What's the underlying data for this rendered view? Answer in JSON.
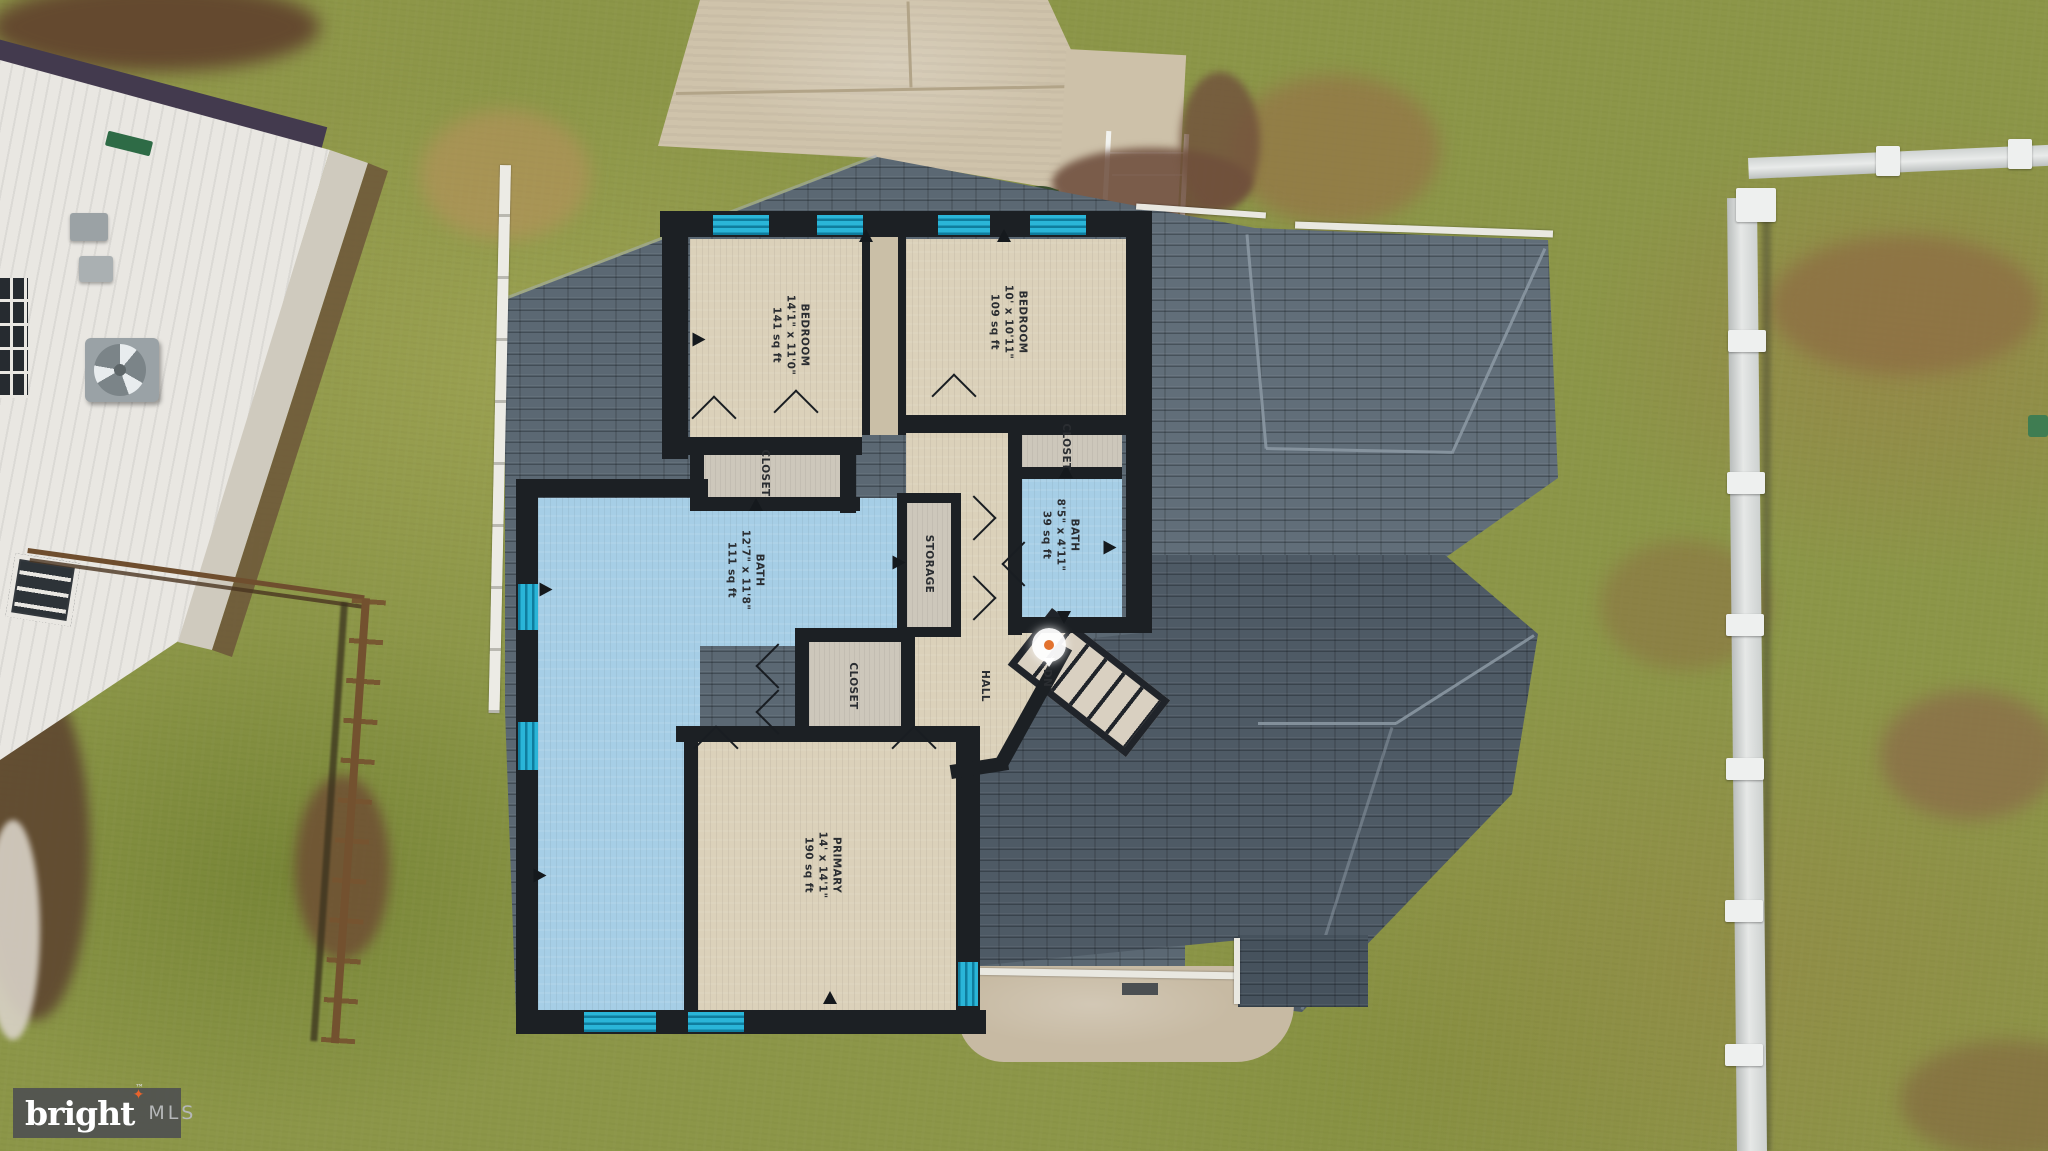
{
  "watermark": {
    "brand": "bright",
    "tm": "™",
    "suffix": "MLS"
  },
  "floorplan": {
    "rooms": [
      {
        "name": "BEDROOM",
        "dims": "14'1\" x 11'0\"",
        "area": "141 sq ft"
      },
      {
        "name": "BEDROOM",
        "dims": "10' x 10'11\"",
        "area": "109 sq ft"
      },
      {
        "name": "BATH",
        "dims": "12'7\" x 11'8\"",
        "area": "111 sq ft"
      },
      {
        "name": "BATH",
        "dims": "8'5\" x 4'11\"",
        "area": "39 sq ft"
      },
      {
        "name": "PRIMARY",
        "dims": "14' x 14'1\"",
        "area": "190 sq ft"
      },
      {
        "name": "CLOSET",
        "dims": "",
        "area": ""
      },
      {
        "name": "CLOSET",
        "dims": "",
        "area": ""
      },
      {
        "name": "CLOSET",
        "dims": "",
        "area": ""
      },
      {
        "name": "STORAGE",
        "dims": "",
        "area": ""
      },
      {
        "name": "HALL",
        "dims": "",
        "area": ""
      },
      {
        "name": "DN",
        "dims": "",
        "area": ""
      }
    ],
    "colors": {
      "wall": "#1c2024",
      "room_beige": "#dbd1ba",
      "bath_blue": "#a6cee6",
      "closet_gray": "#cdc7bb",
      "window_teal": "#1ba2c6"
    },
    "arrows": [
      {
        "x": 866,
        "y": 236,
        "r": 0
      },
      {
        "x": 1004,
        "y": 236,
        "r": 0
      },
      {
        "x": 699,
        "y": 340,
        "r": 90
      },
      {
        "x": 756,
        "y": 505,
        "r": 0
      },
      {
        "x": 546,
        "y": 590,
        "r": 90
      },
      {
        "x": 899,
        "y": 563,
        "r": 90
      },
      {
        "x": 1066,
        "y": 472,
        "r": 0
      },
      {
        "x": 1110,
        "y": 548,
        "r": 90
      },
      {
        "x": 1064,
        "y": 618,
        "r": 180
      },
      {
        "x": 540,
        "y": 876,
        "r": 90
      },
      {
        "x": 830,
        "y": 998,
        "r": 0
      }
    ],
    "icons": {
      "direction_arrow": "solid-triangle",
      "camera_360": "360-view-pin"
    }
  },
  "scene": {
    "roof_color": "#57636e",
    "grass_color": "#8c9648",
    "concrete_color": "#cfc3ab",
    "fence_right_color": "#dfe2e1",
    "fence_left_color": "#6f4e2e"
  }
}
